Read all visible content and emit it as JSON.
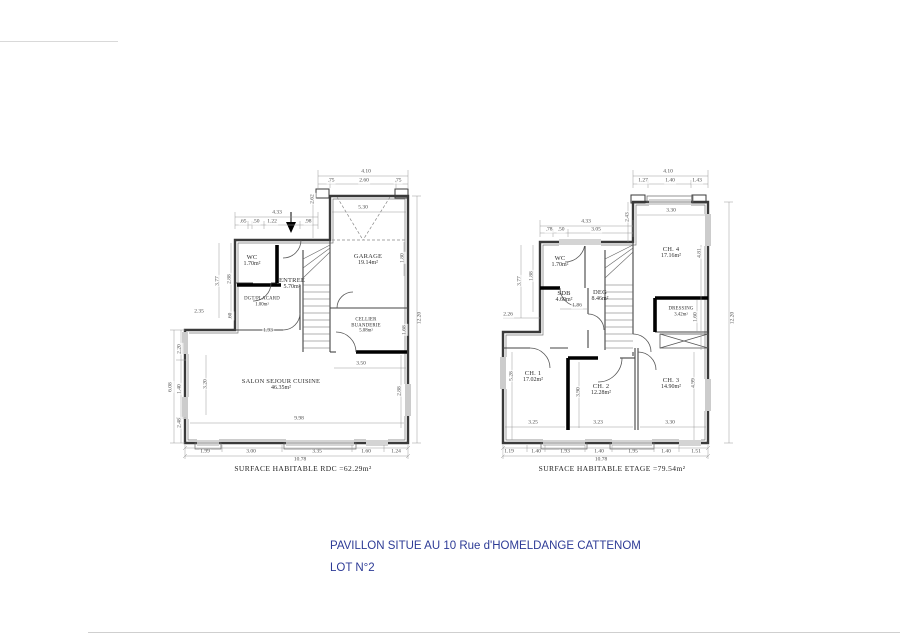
{
  "page": {
    "background": "#ffffff",
    "title_line1": "PAVILLON SITUE AU 10 Rue d'HOMELDANGE CATTENOM",
    "title_line2": "LOT N°2",
    "title_color": "#2d3b96"
  },
  "rdc_plan": {
    "caption": "SURFACE HABITABLE RDC =62.29m²",
    "total_width": "10.78",
    "rooms": [
      {
        "name": "WC",
        "area": "1.70m²",
        "x": 252,
        "y": 261
      },
      {
        "name": "ENTREE",
        "area": "5.70m²",
        "x": 292,
        "y": 284
      },
      {
        "name": "DGT/PLACARD",
        "area": "1.00m²",
        "x": 262,
        "y": 302,
        "small": true
      },
      {
        "name": "GARAGE",
        "area": "19.14m²",
        "x": 368,
        "y": 260
      },
      {
        "name": "CELLIER\nBUANDERIE",
        "area": "5.08m²",
        "x": 366,
        "y": 326,
        "small": true
      },
      {
        "name": "SALON  SEJOUR CUISINE",
        "area": "46.35m²",
        "x": 281,
        "y": 385
      }
    ],
    "dimensions": [
      {
        "t": "4.10",
        "x": 366,
        "y": 172
      },
      {
        "t": ".75",
        "x": 331,
        "y": 181
      },
      {
        "t": "2.60",
        "x": 364,
        "y": 181
      },
      {
        "t": ".75",
        "x": 398,
        "y": 181
      },
      {
        "t": "5.30",
        "x": 363,
        "y": 208
      },
      {
        "t": "4.33",
        "x": 277,
        "y": 213
      },
      {
        "t": ".65",
        "x": 243,
        "y": 222
      },
      {
        "t": ".50",
        "x": 256,
        "y": 222
      },
      {
        "t": "1.22",
        "x": 272,
        "y": 222
      },
      {
        "t": ".98",
        "x": 308,
        "y": 222
      },
      {
        "t": "2.62",
        "x": 313,
        "y": 199,
        "r": 1
      },
      {
        "t": "1.80",
        "x": 403,
        "y": 258,
        "r": 1
      },
      {
        "t": "3.77",
        "x": 218,
        "y": 281,
        "r": 1
      },
      {
        "t": "2.88",
        "x": 230,
        "y": 279,
        "r": 1
      },
      {
        "t": "2.35",
        "x": 199,
        "y": 312
      },
      {
        "t": ".60",
        "x": 231,
        "y": 316,
        "r": 1
      },
      {
        "t": "1.93",
        "x": 268,
        "y": 331
      },
      {
        "t": "1.68",
        "x": 405,
        "y": 330,
        "r": 1
      },
      {
        "t": "3.50",
        "x": 361,
        "y": 364
      },
      {
        "t": "2.88",
        "x": 400,
        "y": 391,
        "r": 1
      },
      {
        "t": "3.20",
        "x": 206,
        "y": 384,
        "r": 1
      },
      {
        "t": "2.20",
        "x": 180,
        "y": 349,
        "r": 1
      },
      {
        "t": "1.40",
        "x": 180,
        "y": 389,
        "r": 1
      },
      {
        "t": "2.48",
        "x": 180,
        "y": 423,
        "r": 1
      },
      {
        "t": "6.08",
        "x": 171,
        "y": 387,
        "r": 1
      },
      {
        "t": "12.20",
        "x": 420,
        "y": 318,
        "r": 1
      },
      {
        "t": "9.98",
        "x": 299,
        "y": 419
      },
      {
        "t": "1.99",
        "x": 205,
        "y": 452
      },
      {
        "t": "3.00",
        "x": 251,
        "y": 452
      },
      {
        "t": "3.35",
        "x": 317,
        "y": 452
      },
      {
        "t": "1.60",
        "x": 366,
        "y": 452
      },
      {
        "t": "1.24",
        "x": 396,
        "y": 452
      },
      {
        "t": "10.78",
        "x": 300,
        "y": 460
      }
    ]
  },
  "etage_plan": {
    "caption": "SURFACE HABITABLE  ETAGE =79.54m²",
    "total_width": "10.78",
    "rooms": [
      {
        "name": "WC",
        "area": "1.70m²",
        "x": 560,
        "y": 262
      },
      {
        "name": "SDB",
        "area": "4.60m²",
        "x": 564,
        "y": 297
      },
      {
        "name": "DEG",
        "area": "8.46m²",
        "x": 600,
        "y": 296
      },
      {
        "name": "CH. 4",
        "area": "17.16m²",
        "x": 671,
        "y": 253
      },
      {
        "name": "DRESSING",
        "area": "3.42m²",
        "x": 681,
        "y": 312,
        "small": true
      },
      {
        "name": "CH. 1",
        "area": "17.02m²",
        "x": 533,
        "y": 377
      },
      {
        "name": "CH. 2",
        "area": "12.28m²",
        "x": 601,
        "y": 390
      },
      {
        "name": "CH. 3",
        "area": "14.90m²",
        "x": 671,
        "y": 384
      }
    ],
    "dimensions": [
      {
        "t": "4.10",
        "x": 668,
        "y": 172
      },
      {
        "t": "1.27",
        "x": 643,
        "y": 181
      },
      {
        "t": "1.40",
        "x": 670,
        "y": 181
      },
      {
        "t": "1.43",
        "x": 697,
        "y": 181
      },
      {
        "t": "3.30",
        "x": 671,
        "y": 211
      },
      {
        "t": "2.43",
        "x": 628,
        "y": 217,
        "r": 1
      },
      {
        "t": "4.33",
        "x": 586,
        "y": 222
      },
      {
        "t": ".78",
        "x": 549,
        "y": 230
      },
      {
        "t": ".50",
        "x": 561,
        "y": 230
      },
      {
        "t": "3.05",
        "x": 596,
        "y": 230
      },
      {
        "t": "3.77",
        "x": 520,
        "y": 281,
        "r": 1
      },
      {
        "t": "1.88",
        "x": 532,
        "y": 276,
        "r": 1
      },
      {
        "t": "1.86",
        "x": 577,
        "y": 306
      },
      {
        "t": "2.26",
        "x": 508,
        "y": 315
      },
      {
        "t": "4.81",
        "x": 700,
        "y": 253,
        "r": 1
      },
      {
        "t": "1.60",
        "x": 696,
        "y": 317,
        "r": 1
      },
      {
        "t": "12.20",
        "x": 733,
        "y": 318,
        "r": 1
      },
      {
        "t": "5.28",
        "x": 512,
        "y": 376,
        "r": 1
      },
      {
        "t": "3.90",
        "x": 579,
        "y": 392,
        "r": 1
      },
      {
        "t": "4.99",
        "x": 694,
        "y": 383,
        "r": 1
      },
      {
        "t": "3.25",
        "x": 533,
        "y": 423
      },
      {
        "t": "3.23",
        "x": 598,
        "y": 423
      },
      {
        "t": "3.30",
        "x": 670,
        "y": 423
      },
      {
        "t": "1.19",
        "x": 509,
        "y": 452
      },
      {
        "t": "1.40",
        "x": 536,
        "y": 452
      },
      {
        "t": "1.93",
        "x": 565,
        "y": 452
      },
      {
        "t": "1.40",
        "x": 599,
        "y": 452
      },
      {
        "t": "1.95",
        "x": 633,
        "y": 452
      },
      {
        "t": "1.40",
        "x": 666,
        "y": 452
      },
      {
        "t": "1.51",
        "x": 696,
        "y": 452
      },
      {
        "t": "10.78",
        "x": 601,
        "y": 460
      }
    ]
  }
}
